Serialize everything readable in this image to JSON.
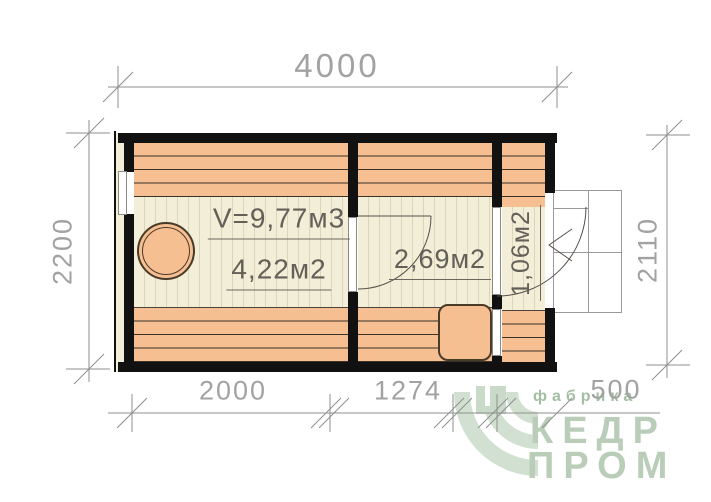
{
  "dimensions": {
    "top": "4000",
    "left": "2200",
    "right": "2110",
    "bottom": [
      "2000",
      "1274",
      "500"
    ]
  },
  "rooms": {
    "steam_room": {
      "volume_label": "V=9,77м3",
      "area_label": "4,22м2"
    },
    "wash_room": {
      "area_label": "2,69м2"
    },
    "entrance": {
      "area_label": "1,06м2"
    }
  },
  "logo": {
    "tagline": "фабрика",
    "word_line1": "КЕДР",
    "word_line2": "ПРОМ"
  },
  "colors": {
    "bench_orange": "#f6bf92",
    "floor_cream": "#f2eed8",
    "wall_black": "#111111",
    "dimension_gray": "#8f8f8f",
    "brand_green": "#b9cdb9"
  }
}
